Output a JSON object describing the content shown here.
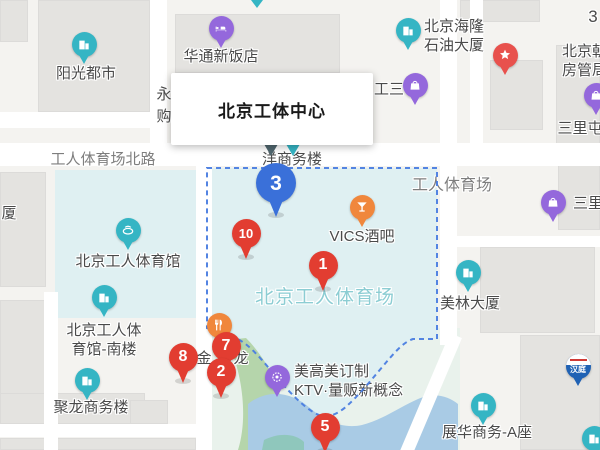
{
  "canvas": {
    "width": 600,
    "height": 450
  },
  "colors": {
    "teal_pin": "#35b5c4",
    "purple_pin": "#9468dc",
    "orange_pin": "#f0873c",
    "red_pin": "#e23d31",
    "blue_pin": "#3a70d9",
    "star_pin": "#e8514d",
    "hanting_blue": "#2062b4",
    "hanting_red": "#d03a36",
    "dashed_border": "#4a7de0",
    "area_teal": "#dff0f2",
    "water": "#a9cbe5",
    "park": "#b5d5ab",
    "park_dark": "#8fc7bc",
    "park_pale": "#e9f2ec",
    "building": "#e4e3e0",
    "bg": "#f4f3f0",
    "road": "#ffffff",
    "label": "#4a4a4a",
    "road_label": "#7e7e7e",
    "stadium_label": "#8ccdd3"
  },
  "info_box": {
    "title": "北京工体中心"
  },
  "numbered_markers": [
    {
      "number": "3",
      "type": "blue",
      "x": 276,
      "y": 183
    },
    {
      "number": "10",
      "type": "red",
      "x": 246,
      "y": 233
    },
    {
      "number": "1",
      "type": "red",
      "x": 323,
      "y": 265
    },
    {
      "number": "7",
      "type": "red",
      "x": 226,
      "y": 346
    },
    {
      "number": "2",
      "type": "red",
      "x": 221,
      "y": 372
    },
    {
      "number": "8",
      "type": "red",
      "x": 183,
      "y": 357
    },
    {
      "number": "5",
      "type": "red",
      "x": 325,
      "y": 427
    }
  ],
  "pois": [
    {
      "name": "yangguang-dushi",
      "icon": "building",
      "color_key": "teal_pin",
      "x": 84,
      "y": 44,
      "lines": [
        "阳光都市"
      ],
      "label_x": 86,
      "label_y": 73,
      "align": "center"
    },
    {
      "name": "huatong-xinfandian",
      "icon": "bed",
      "color_key": "purple_pin",
      "x": 221,
      "y": 28,
      "lines": [
        "华通新饭店"
      ],
      "label_x": 221,
      "label_y": 56,
      "align": "center"
    },
    {
      "name": "hailong-shiyou-dasha",
      "icon": "building",
      "color_key": "teal_pin",
      "x": 408,
      "y": 30,
      "lines": [
        "北京海隆",
        "石油大厦"
      ],
      "label_x": 424,
      "label_y": 26,
      "align": "left"
    },
    {
      "name": "chaoyang-fangguanju",
      "icon": "star",
      "color_key": "star_pin",
      "x": 505,
      "y": 55,
      "lines": [
        "北京朝",
        "房管局"
      ],
      "label_x": 562,
      "label_y": 51,
      "align": "left"
    },
    {
      "name": "sanlitun-north",
      "icon": "bag",
      "color_key": "purple_pin",
      "x": 596,
      "y": 95,
      "lines": [
        "三里屯"
      ],
      "label_x": 580,
      "label_y": 128,
      "align": "center"
    },
    {
      "name": "gongsan-mall",
      "icon": "bag",
      "color_key": "purple_pin",
      "x": 415,
      "y": 85,
      "lines": []
    },
    {
      "name": "sanlitun-east",
      "icon": "bag",
      "color_key": "purple_pin",
      "x": 553,
      "y": 202,
      "lines": [
        "三里屯"
      ],
      "label_x": 573,
      "label_y": 203,
      "align": "left"
    },
    {
      "name": "gongren-tiyuguan",
      "icon": "stadium",
      "color_key": "teal_pin",
      "x": 128,
      "y": 230,
      "lines": [
        "北京工人体育馆"
      ],
      "label_x": 128,
      "label_y": 261,
      "align": "center"
    },
    {
      "name": "tiyuguan-nanlou",
      "icon": "building",
      "color_key": "teal_pin",
      "x": 104,
      "y": 297,
      "lines": [
        "北京工人体",
        "育馆-南楼"
      ],
      "label_x": 104,
      "label_y": 330,
      "align": "center"
    },
    {
      "name": "julong-shangwulou",
      "icon": "building",
      "color_key": "teal_pin",
      "x": 87,
      "y": 380,
      "lines": [
        "聚龙商务楼"
      ],
      "label_x": 91,
      "label_y": 407,
      "align": "center"
    },
    {
      "name": "vics-bar",
      "icon": "cocktail",
      "color_key": "orange_pin",
      "x": 362,
      "y": 207,
      "lines": [
        "VICS酒吧"
      ],
      "label_x": 362,
      "label_y": 236,
      "align": "center"
    },
    {
      "name": "meilin-dasha",
      "icon": "building",
      "color_key": "teal_pin",
      "x": 468,
      "y": 272,
      "lines": [
        "美林大厦"
      ],
      "label_x": 470,
      "label_y": 303,
      "align": "center"
    },
    {
      "name": "restaurant-jin",
      "icon": "food",
      "color_key": "orange_pin",
      "x": 219,
      "y": 325,
      "lines": []
    },
    {
      "name": "meigaomei-ktv",
      "icon": "ktv",
      "color_key": "purple_pin",
      "x": 277,
      "y": 377,
      "lines": [
        "美高美订制",
        "KTV·量贩新概念"
      ],
      "label_x": 294,
      "label_y": 371,
      "align": "left"
    },
    {
      "name": "zhanhua-shangwu-a",
      "icon": "building",
      "color_key": "teal_pin",
      "x": 483,
      "y": 405,
      "lines": [
        "展华商务-A座"
      ],
      "label_x": 487,
      "label_y": 432,
      "align": "center"
    },
    {
      "name": "hanting-hotel",
      "icon": "hanting",
      "color_key": "hanting_blue",
      "x": 578,
      "y": 366,
      "lines": []
    },
    {
      "name": "clipped-poi-corner",
      "icon": "building",
      "color_key": "teal_pin",
      "x": 594,
      "y": 438,
      "lines": []
    }
  ],
  "texts": [
    {
      "name": "road-gongti-beilu",
      "text": "工人体育场北路",
      "x": 103,
      "y": 157,
      "size": 15,
      "color_key": "road_label",
      "align": "center"
    },
    {
      "name": "area-gongren-tiyuchang",
      "text": "工人体育场",
      "x": 452,
      "y": 180,
      "size": 16,
      "color_key": "road_label",
      "align": "center"
    },
    {
      "name": "stadium-name",
      "text": "北京工人体育场",
      "x": 325,
      "y": 293,
      "size": 19,
      "color_key": "stadium_label",
      "align": "center"
    },
    {
      "name": "partial-yang-shangwulou",
      "text": "洋商务楼",
      "x": 262,
      "y": 157,
      "size": 15,
      "color_key": "label",
      "align": "left"
    },
    {
      "name": "partial-gongsan",
      "text": "工三",
      "x": 374,
      "y": 87,
      "size": 15,
      "color_key": "label",
      "align": "left"
    },
    {
      "name": "partial-yong",
      "text": "永",
      "x": 164,
      "y": 92,
      "size": 15,
      "color_key": "label",
      "align": "center"
    },
    {
      "name": "partial-gou",
      "text": "购",
      "x": 164,
      "y": 114,
      "size": 15,
      "color_key": "label",
      "align": "center"
    },
    {
      "name": "partial-sha",
      "text": "厦",
      "x": 9,
      "y": 211,
      "size": 15,
      "color_key": "label",
      "align": "center"
    },
    {
      "name": "partial-three",
      "text": "3",
      "x": 593,
      "y": 17,
      "size": 17,
      "color_key": "label",
      "align": "center"
    },
    {
      "name": "partial-jin",
      "text": "金",
      "x": 204,
      "y": 356,
      "size": 15,
      "color_key": "label",
      "align": "center"
    },
    {
      "name": "partial-long",
      "text": "龙",
      "x": 241,
      "y": 356,
      "size": 15,
      "color_key": "label",
      "align": "center"
    }
  ]
}
